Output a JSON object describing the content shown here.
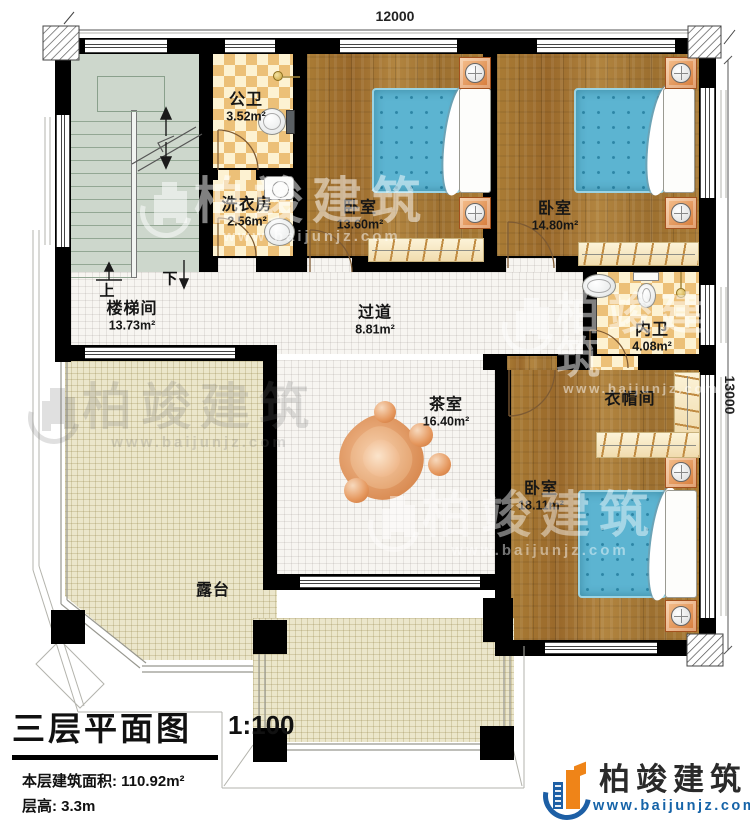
{
  "plan": {
    "dimensions": {
      "top": "12000",
      "right": "13000"
    },
    "stair_labels": {
      "up": "上",
      "down": "下"
    },
    "rooms": [
      {
        "name": "公卫",
        "area": "3.52m²"
      },
      {
        "name": "洗衣房",
        "area": "2.56m²"
      },
      {
        "name": "卧室",
        "area": "13.60m²"
      },
      {
        "name": "卧室",
        "area": "14.80m²"
      },
      {
        "name": "楼梯间",
        "area": "13.73m²"
      },
      {
        "name": "过道",
        "area": "8.81m²"
      },
      {
        "name": "内卫",
        "area": "4.08m²"
      },
      {
        "name": "衣帽间",
        "area": ""
      },
      {
        "name": "茶室",
        "area": "16.40m²"
      },
      {
        "name": "卧室",
        "area": "18.11m²"
      },
      {
        "name": "露台",
        "area": ""
      }
    ]
  },
  "title_block": {
    "title": "三层平面图",
    "scale": "1:100",
    "floor_area": "本层建筑面积: 110.92m²",
    "floor_height": "层高: 3.3m"
  },
  "branding": {
    "logo_name": "柏竣建筑",
    "logo_url": "www.baijunjz.com"
  },
  "watermark": {
    "name": "柏竣建筑",
    "url": "www.baijunjz.com"
  },
  "colors": {
    "wall": "#000000",
    "wood": "#a5782f",
    "tile": "#ecc078",
    "terrace": "#ebe6cb",
    "stairs": "#cdd7cc",
    "bed": "#5cb4d1",
    "logo-blue": "#1d5fa5",
    "logo-orange": "#ef8418",
    "url-blue": "#1563a8"
  }
}
